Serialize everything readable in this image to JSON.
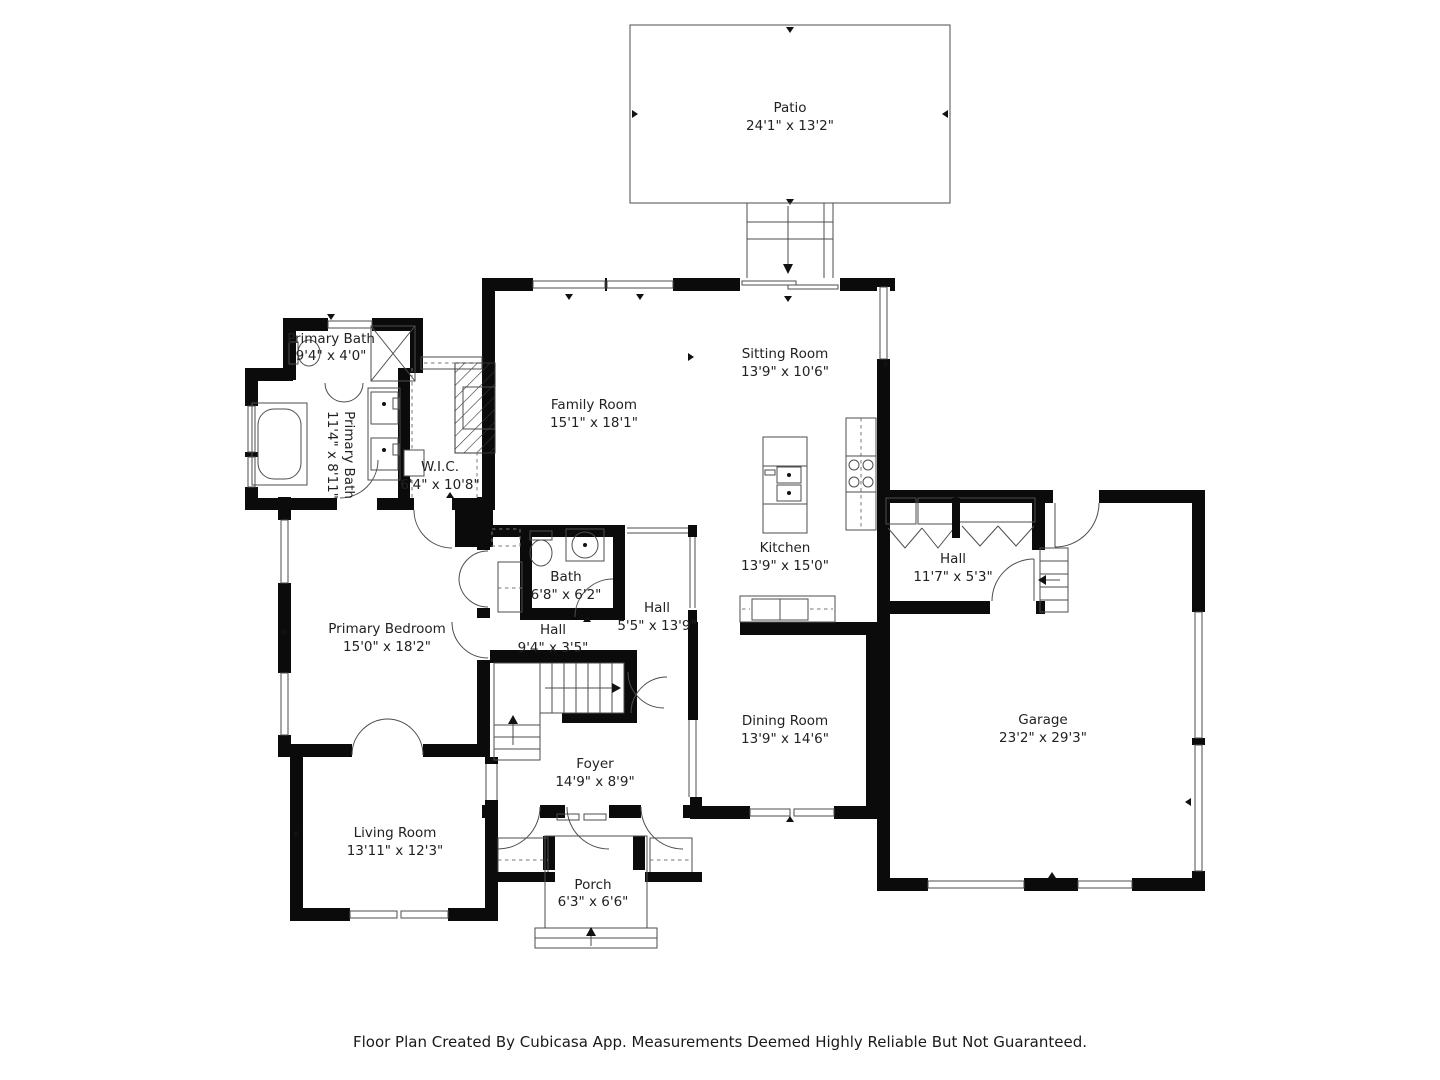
{
  "title": "Floor plan",
  "footer": "Floor Plan Created By Cubicasa App. Measurements Deemed Highly Reliable But Not Guaranteed.",
  "colors": {
    "wall": "#0b0b0b",
    "thin_line": "#4d4d4d",
    "background": "#ffffff",
    "text": "#222222"
  },
  "rooms": {
    "patio": {
      "name": "Patio",
      "dims": "24'1\" x 13'2\""
    },
    "primary_bath_small": {
      "name": "Primary Bath",
      "dims": "9'4\" x 4'0\""
    },
    "primary_bath": {
      "name": "Primary Bath",
      "dims": "11'4\" x 8'11\""
    },
    "wic": {
      "name": "W.I.C.",
      "dims": "6'4\" x 10'8\""
    },
    "family_room": {
      "name": "Family Room",
      "dims": "15'1\" x 18'1\""
    },
    "sitting_room": {
      "name": "Sitting Room",
      "dims": "13'9\" x 10'6\""
    },
    "kitchen": {
      "name": "Kitchen",
      "dims": "13'9\" x 15'0\""
    },
    "hall_right": {
      "name": "Hall",
      "dims": "11'7\" x 5'3\""
    },
    "bath": {
      "name": "Bath",
      "dims": "6'8\" x 6'2\""
    },
    "hall_center": {
      "name": "Hall",
      "dims": "5'5\" x 13'9\""
    },
    "hall_small": {
      "name": "Hall",
      "dims": "9'4\" x 3'5\""
    },
    "primary_bedroom": {
      "name": "Primary Bedroom",
      "dims": "15'0\" x 18'2\""
    },
    "dining_room": {
      "name": "Dining Room",
      "dims": "13'9\" x 14'6\""
    },
    "garage": {
      "name": "Garage",
      "dims": "23'2\" x 29'3\""
    },
    "foyer": {
      "name": "Foyer",
      "dims": "14'9\" x 8'9\""
    },
    "living_room": {
      "name": "Living Room",
      "dims": "13'11\" x 12'3\""
    },
    "porch": {
      "name": "Porch",
      "dims": "6'3\" x 6'6\""
    }
  }
}
